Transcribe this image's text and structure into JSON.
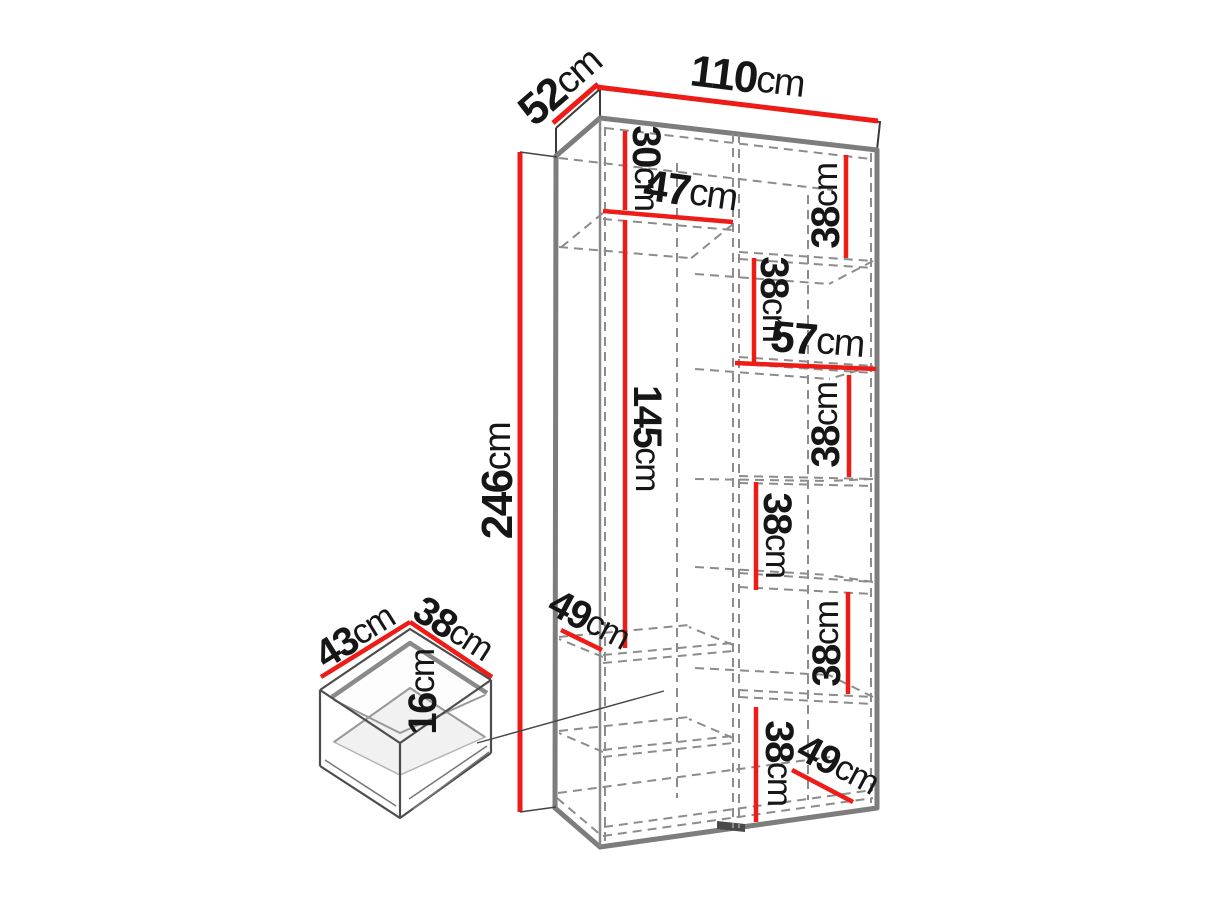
{
  "diagram": {
    "type": "furniture-dimension-diagram",
    "subject": "two-door wardrobe with interior shelves and drawer",
    "units": "cm",
    "colors": {
      "dimension_red": "#ee1b17",
      "carcass_gray": "#7d7d7d",
      "dashed_gray": "#8c8c8c",
      "label_black": "#161616",
      "background": "#ffffff"
    },
    "wardrobe": {
      "width": {
        "num": "110",
        "unit": "cm"
      },
      "depth": {
        "num": "52",
        "unit": "cm"
      },
      "height": {
        "num": "246",
        "unit": "cm"
      },
      "top_compartment_height": {
        "num": "30",
        "unit": "cm"
      },
      "left_section_width": {
        "num": "47",
        "unit": "cm"
      },
      "hanging_space_height": {
        "num": "145",
        "unit": "cm"
      },
      "left_shelf_depth": {
        "num": "49",
        "unit": "cm"
      },
      "right_section_width": {
        "num": "57",
        "unit": "cm"
      },
      "right_shelf_gaps": [
        {
          "num": "38",
          "unit": "cm"
        },
        {
          "num": "38",
          "unit": "cm"
        },
        {
          "num": "38",
          "unit": "cm"
        },
        {
          "num": "38",
          "unit": "cm"
        },
        {
          "num": "38",
          "unit": "cm"
        },
        {
          "num": "38",
          "unit": "cm"
        }
      ],
      "bottom_shelf_depth": {
        "num": "49",
        "unit": "cm"
      }
    },
    "drawer": {
      "width": {
        "num": "43",
        "unit": "cm"
      },
      "depth": {
        "num": "38",
        "unit": "cm"
      },
      "height": {
        "num": "16",
        "unit": "cm"
      }
    }
  }
}
